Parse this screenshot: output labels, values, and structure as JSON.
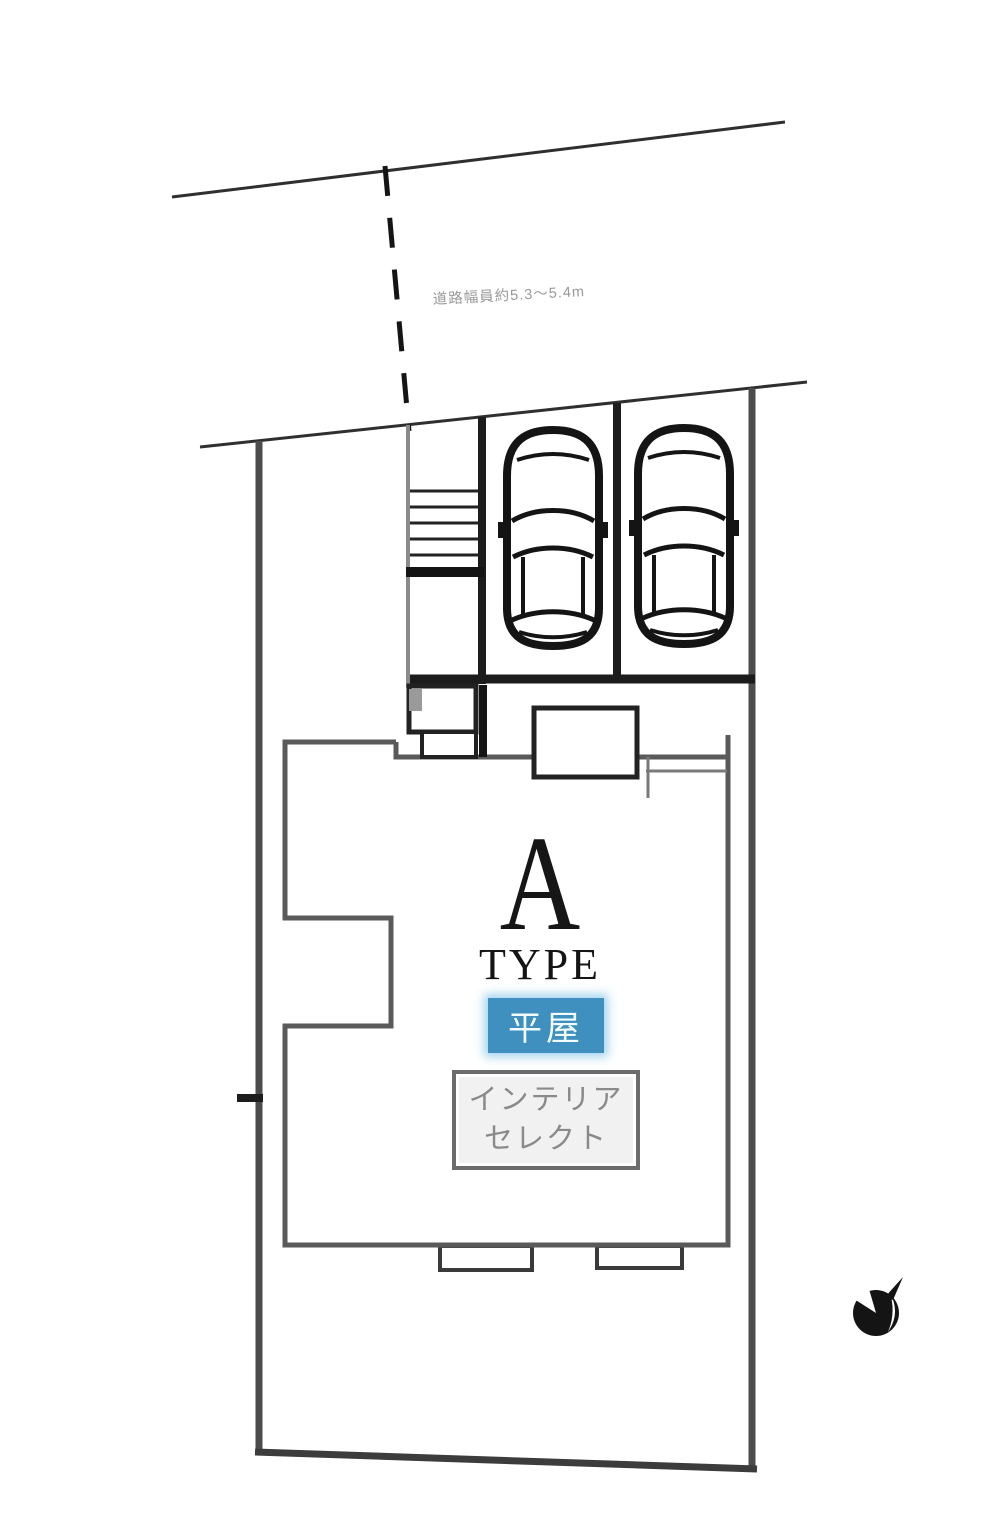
{
  "site_plan": {
    "road_label": "道路幅員約5.3〜5.4m",
    "unit": {
      "type_letter": "A",
      "type_word": "TYPE",
      "story_badge": "平屋",
      "select_box_line1": "インテリア",
      "select_box_line2": "セレクト"
    },
    "features": {
      "parking_spaces": 2,
      "cars_shown": 2,
      "has_stairs": true,
      "has_compass": true
    },
    "icons": [
      "car-top-view-icon",
      "compass-north-icon"
    ],
    "colors": {
      "badge_blue": "#3f90be",
      "badge_glow": "#94cdec",
      "line_black": "#1c1c1c",
      "boundary_gray": "#4c4c4c",
      "building_gray": "#5a5a5a",
      "label_gray": "#8a8a8a",
      "background": "#ffffff"
    }
  }
}
